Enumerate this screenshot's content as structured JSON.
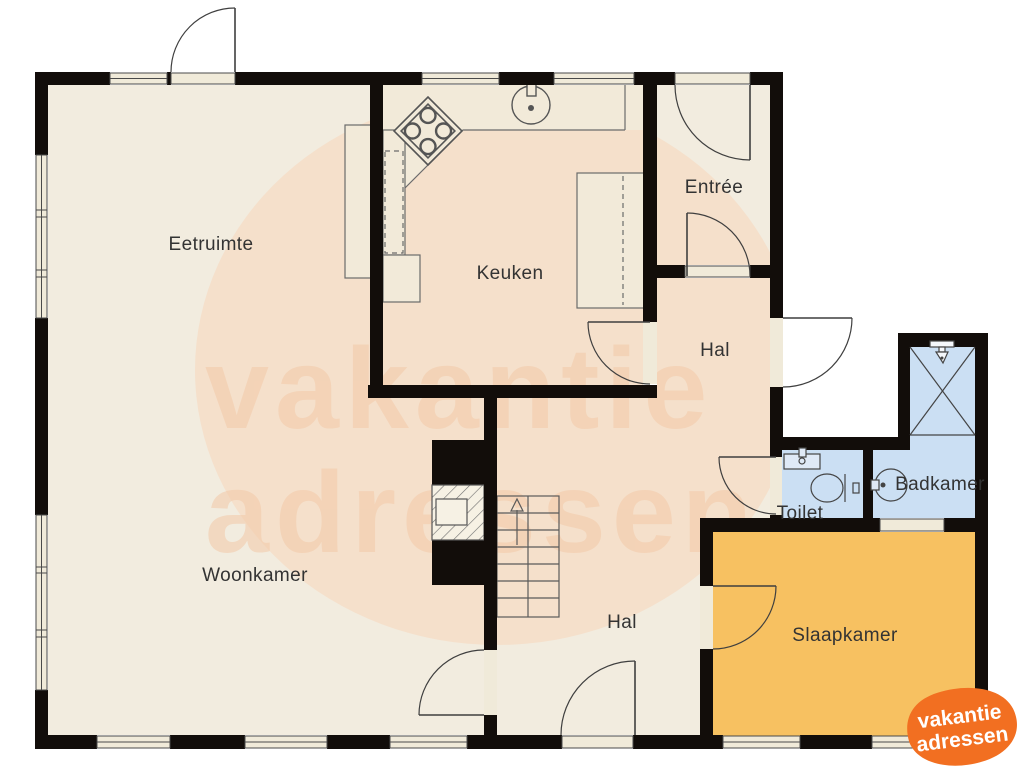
{
  "floorplan": {
    "rooms": {
      "eetruimte": "Eetruimte",
      "keuken": "Keuken",
      "entree": "Entrée",
      "hal_top": "Hal",
      "hal_bottom": "Hal",
      "toilet": "Toilet",
      "badkamer": "Badkamer",
      "woonkamer": "Woonkamer",
      "slaapkamer": "Slaapkamer"
    },
    "colors": {
      "wall": "#120d0a",
      "floor": "#f2ecdf",
      "floor_tint": "#fbd0b0",
      "wet_floor": "#cbdff3",
      "bedroom_floor": "#f7c161",
      "window_fill": "#f0ead9",
      "fixture_fill": "#f4eee0",
      "line": "#4a4a4a",
      "label": "#333333",
      "watermark_text": "#f3c9a8",
      "logo_orange": "#f26f21",
      "logo_text": "#ffffff"
    },
    "watermark": {
      "line1": "vakantie",
      "line2": "adressen"
    },
    "logo": {
      "line1": "vakantie",
      "line2": "adressen"
    }
  }
}
